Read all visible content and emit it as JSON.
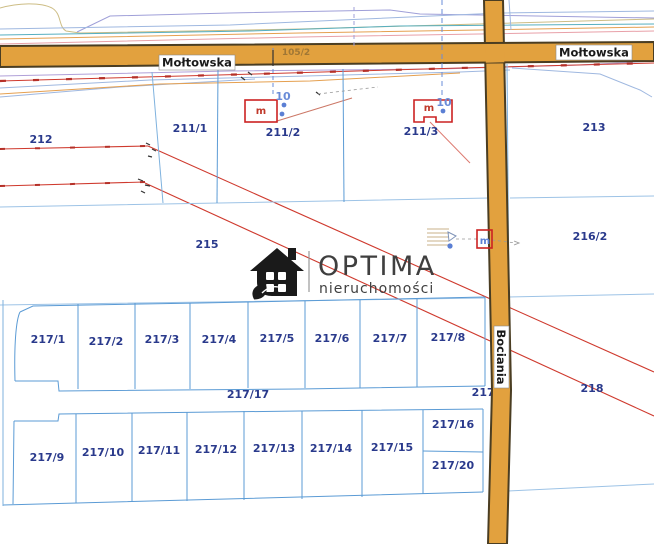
{
  "map": {
    "streets": {
      "moltowska_west": {
        "label": "Mołtowska"
      },
      "moltowska_east": {
        "label": "Mołtowska"
      },
      "bociania": {
        "label": "Bociania"
      }
    },
    "road_parcel": {
      "label": "105/2"
    },
    "watermark": {
      "brand": "OPTIMA",
      "subtitle": "nieruchomości"
    },
    "parcels": [
      {
        "label": "212",
        "x": 41,
        "y": 143
      },
      {
        "label": "211/1",
        "x": 190,
        "y": 132
      },
      {
        "label": "211/2",
        "x": 283,
        "y": 136
      },
      {
        "label": "211/3",
        "x": 421,
        "y": 135
      },
      {
        "label": "213",
        "x": 594,
        "y": 131
      },
      {
        "label": "215",
        "x": 207,
        "y": 248
      },
      {
        "label": "216/2",
        "x": 590,
        "y": 240
      },
      {
        "label": "217/1",
        "x": 48,
        "y": 343
      },
      {
        "label": "217/2",
        "x": 106,
        "y": 345
      },
      {
        "label": "217/3",
        "x": 162,
        "y": 343
      },
      {
        "label": "217/4",
        "x": 219,
        "y": 343
      },
      {
        "label": "217/5",
        "x": 277,
        "y": 342
      },
      {
        "label": "217/6",
        "x": 332,
        "y": 342
      },
      {
        "label": "217/7",
        "x": 390,
        "y": 342
      },
      {
        "label": "217/8",
        "x": 448,
        "y": 341
      },
      {
        "label": "217/17",
        "x": 248,
        "y": 398
      },
      {
        "label": "217/2",
        "x": 489,
        "y": 396,
        "layer": "under"
      },
      {
        "label": "218",
        "x": 592,
        "y": 392
      },
      {
        "label": "217/9",
        "x": 47,
        "y": 461
      },
      {
        "label": "217/10",
        "x": 103,
        "y": 456
      },
      {
        "label": "217/11",
        "x": 159,
        "y": 454
      },
      {
        "label": "217/12",
        "x": 216,
        "y": 453
      },
      {
        "label": "217/13",
        "x": 274,
        "y": 452
      },
      {
        "label": "217/14",
        "x": 331,
        "y": 452
      },
      {
        "label": "217/15",
        "x": 392,
        "y": 451
      },
      {
        "label": "217/16",
        "x": 453,
        "y": 428
      },
      {
        "label": "217/20",
        "x": 453,
        "y": 469
      }
    ],
    "markers": [
      {
        "text": "m",
        "x": 261,
        "y": 114,
        "color": "#c0392b",
        "size": 10
      },
      {
        "text": "10",
        "x": 283,
        "y": 100,
        "color": "#6a8cd8",
        "size": 11
      },
      {
        "text": "m",
        "x": 429,
        "y": 111,
        "color": "#c0392b",
        "size": 10
      },
      {
        "text": "10",
        "x": 444,
        "y": 106,
        "color": "#6a8cd8",
        "size": 11
      },
      {
        "text": "m",
        "x": 485,
        "y": 244,
        "color": "#5b7fd4",
        "size": 10
      }
    ],
    "dots": [
      {
        "x": 284,
        "y": 105
      },
      {
        "x": 282,
        "y": 114
      },
      {
        "x": 443,
        "y": 111
      },
      {
        "x": 450,
        "y": 246
      }
    ],
    "colors": {
      "road_fill": "#e2a13e",
      "road_border": "#4a3d22",
      "parcel_line": "#5b9bd5",
      "light_line": "#9dc3e6",
      "red_line": "#cf3a2e",
      "label_blue": "#2a3a8c"
    }
  }
}
